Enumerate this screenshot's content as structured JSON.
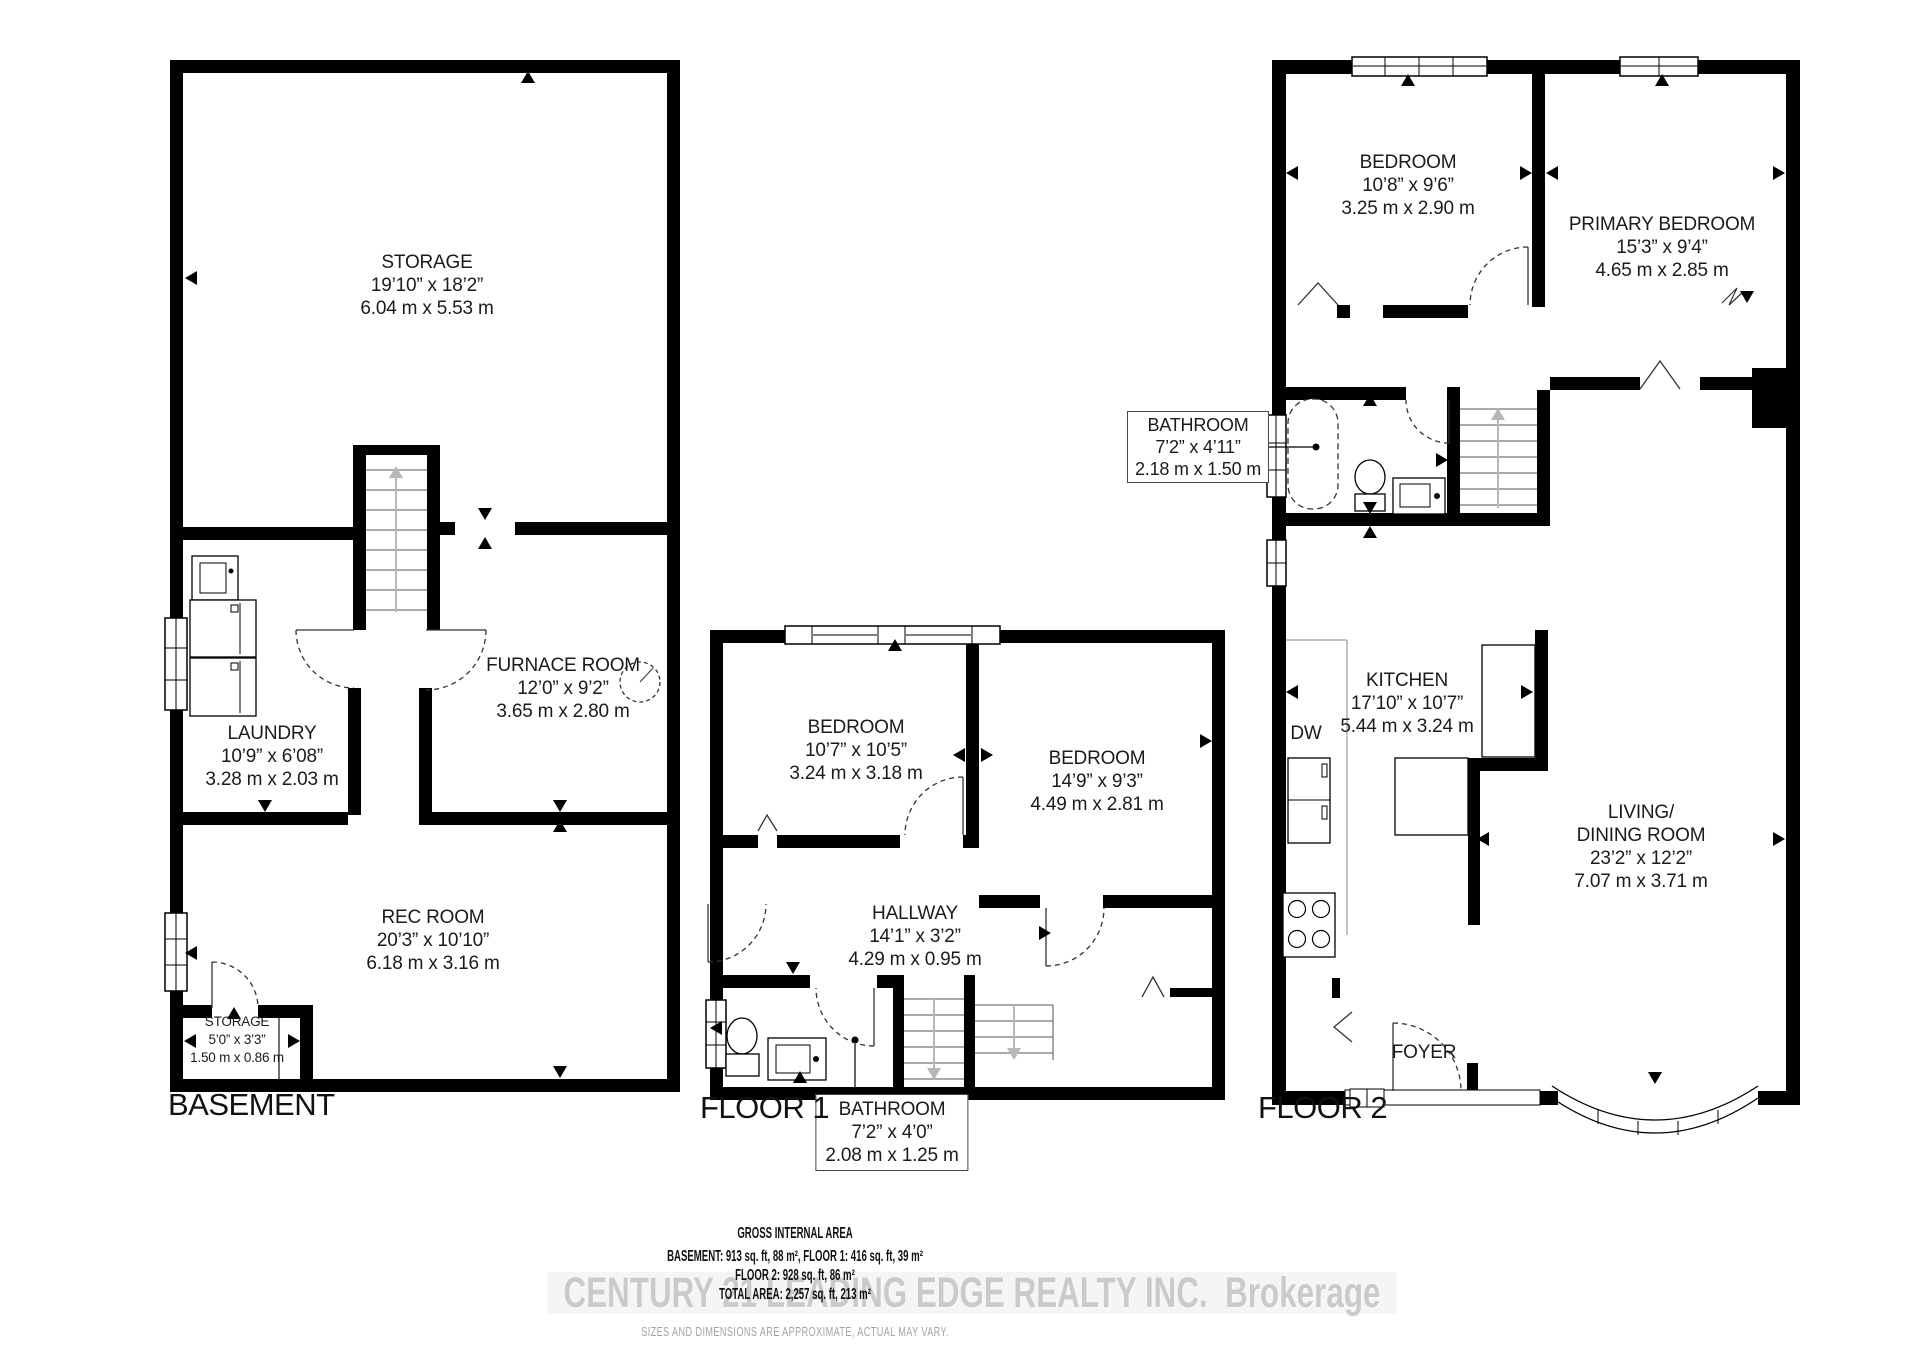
{
  "page": {
    "bg": "#ffffff",
    "wall_color": "#000000",
    "muted_gray": "#a3a3a3"
  },
  "basement": {
    "title": "BASEMENT",
    "rooms": {
      "storage": {
        "name": "STORAGE",
        "imperial": "19’10” x 18’2”",
        "metric": "6.04 m x 5.53 m"
      },
      "furnace": {
        "name": "FURNACE ROOM",
        "imperial": "12’0” x 9’2”",
        "metric": "3.65 m x 2.80 m"
      },
      "laundry": {
        "name": "LAUNDRY",
        "imperial": "10’9” x 6’08”",
        "metric": "3.28 m x 2.03 m"
      },
      "rec": {
        "name": "REC ROOM",
        "imperial": "20’3” x 10’10”",
        "metric": "6.18 m x 3.16 m"
      },
      "storage_small": {
        "name": "STORAGE",
        "imperial": "5’0” x 3’3”",
        "metric": "1.50 m x 0.86 m"
      }
    }
  },
  "floor1": {
    "title": "FLOOR 1",
    "rooms": {
      "bedroom1": {
        "name": "BEDROOM",
        "imperial": "10’7” x 10’5”",
        "metric": "3.24 m x 3.18 m"
      },
      "bedroom2": {
        "name": "BEDROOM",
        "imperial": "14’9” x 9’3”",
        "metric": "4.49 m x 2.81 m"
      },
      "hallway": {
        "name": "HALLWAY",
        "imperial": "14’1” x 3’2”",
        "metric": "4.29 m x 0.95 m"
      },
      "bathroom": {
        "name": "BATHROOM",
        "imperial": "7’2” x 4’0”",
        "metric": "2.08 m x 1.25 m"
      }
    }
  },
  "floor2": {
    "title": "FLOOR 2",
    "rooms": {
      "bedroom": {
        "name": "BEDROOM",
        "imperial": "10’8” x 9’6”",
        "metric": "3.25 m x 2.90 m"
      },
      "primary": {
        "name": "PRIMARY BEDROOM",
        "imperial": "15’3” x 9’4”",
        "metric": "4.65 m x 2.85 m"
      },
      "bathroom": {
        "name": "BATHROOM",
        "imperial": "7’2” x 4’11”",
        "metric": "2.18 m x 1.50 m"
      },
      "kitchen": {
        "name": "KITCHEN",
        "imperial": "17’10” x 10’7”",
        "metric": "5.44 m x 3.24 m"
      },
      "living": {
        "name_line1": "LIVING/",
        "name_line2": "DINING ROOM",
        "imperial": "23’2” x 12’2”",
        "metric": "7.07 m x 3.71 m"
      },
      "foyer": {
        "name": "FOYER"
      },
      "dishwasher": {
        "abbr": "DW"
      }
    }
  },
  "footer": {
    "title": "GROSS INTERNAL AREA",
    "line1": "BASEMENT: 913 sq. ft, 88 m², FLOOR 1: 416 sq. ft, 39 m²",
    "line2": "FLOOR 2: 928 sq. ft, 86 m²",
    "line3": "TOTAL AREA: 2,257 sq. ft, 213 m²",
    "disclaimer": "SIZES AND DIMENSIONS ARE APPROXIMATE, ACTUAL MAY VARY."
  },
  "watermark": {
    "text": "CENTURY 21 LEADING EDGE REALTY INC.  Brokerage"
  }
}
